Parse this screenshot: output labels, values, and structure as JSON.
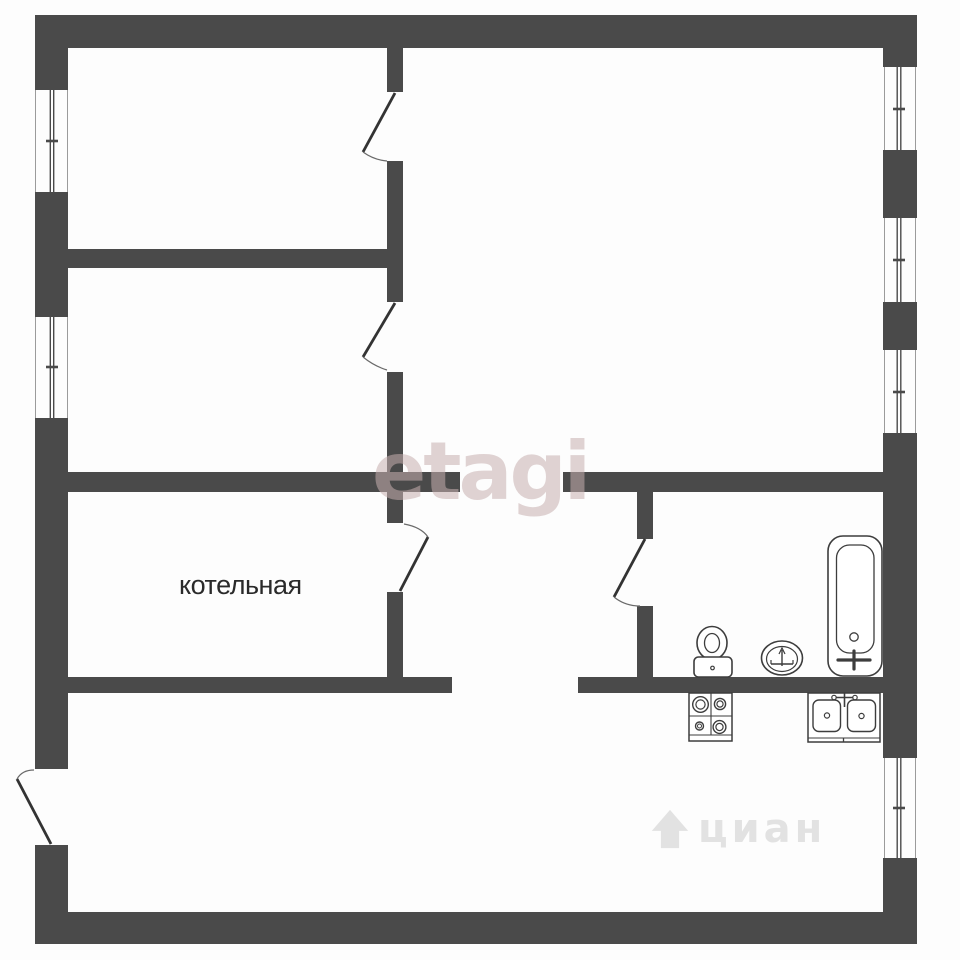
{
  "floorplan": {
    "room_label": "котельная",
    "watermark_primary": "etagi",
    "watermark_secondary": "циан",
    "colors": {
      "wall": "#4a4a4a",
      "fixture_stroke": "#3d3d3d",
      "label_text": "#2a2a2a",
      "watermark_etagi": "rgba(198,174,174,0.55)",
      "watermark_cian": "rgba(165,165,165,0.30)"
    },
    "window_count": 6,
    "door_count": 5,
    "fixtures": [
      "bathtub",
      "washbasin",
      "toilet",
      "stove",
      "kitchen-sink"
    ]
  }
}
